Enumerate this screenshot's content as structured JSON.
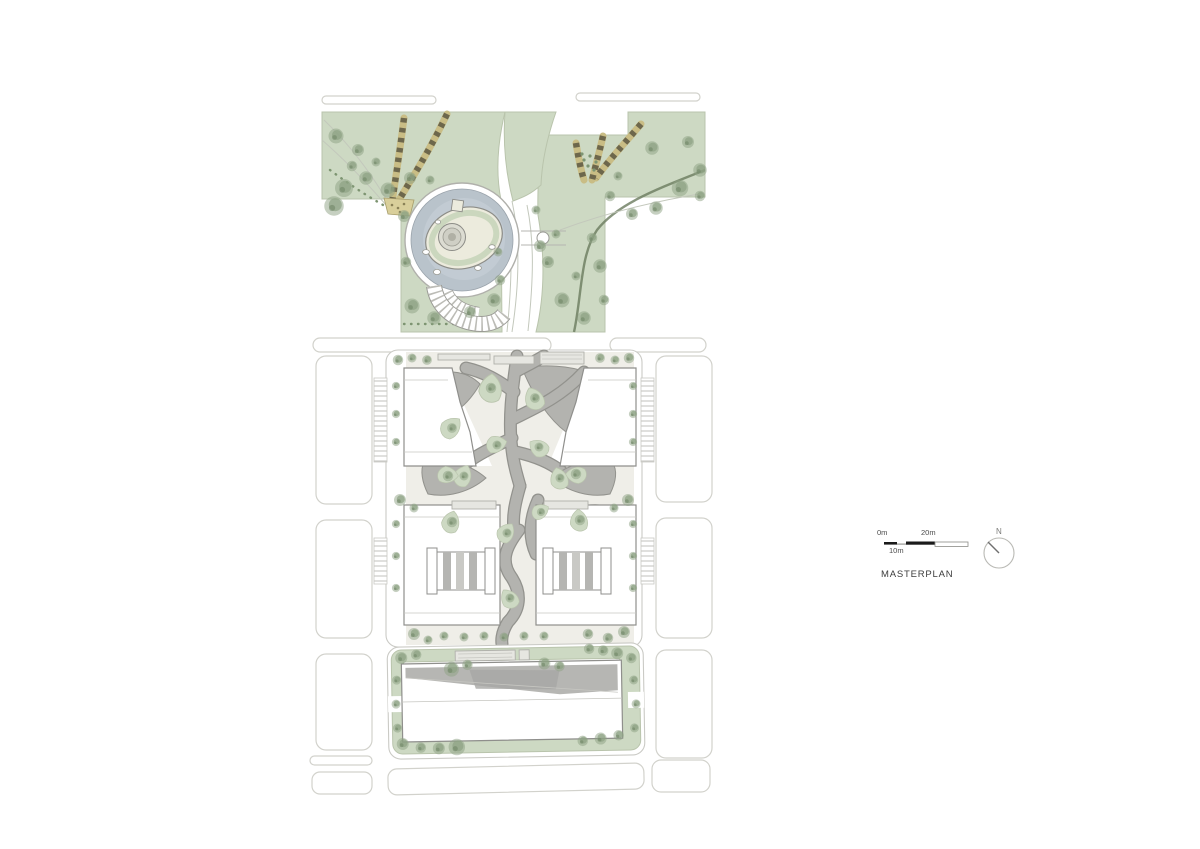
{
  "legend": {
    "title": "MASTERPLAN"
  },
  "scale_bar": {
    "labels": {
      "zero": "0m",
      "ten": "10m",
      "twenty": "20m"
    }
  },
  "north_arrow": {
    "label": "N"
  },
  "colors": {
    "park_green": "#cdd9c3",
    "park_line": "#b9c4ac",
    "tree_green": "#8da283",
    "tree_dark": "#6e8465",
    "shrub_green": "#7d9471",
    "water_blue": "#b9c3cb",
    "water_light": "#c6ced5",
    "island_cream": "#ecebdd",
    "plaza_grey": "#b3b3af",
    "plaza_dark": "#92928d",
    "plaza_bg": "#efeee8",
    "pergola_tan": "#c9bd85",
    "pergola_dark": "#5e5943",
    "road_line": "#d2d2cc",
    "building_line": "#8f8f8c",
    "hedge_dark": "#6a7a5e",
    "text_dark": "#3c3c3c",
    "text_grey": "#7a7a78",
    "canopy_grey": "#e6e6e1",
    "court_grey": "#b6b6b3"
  }
}
